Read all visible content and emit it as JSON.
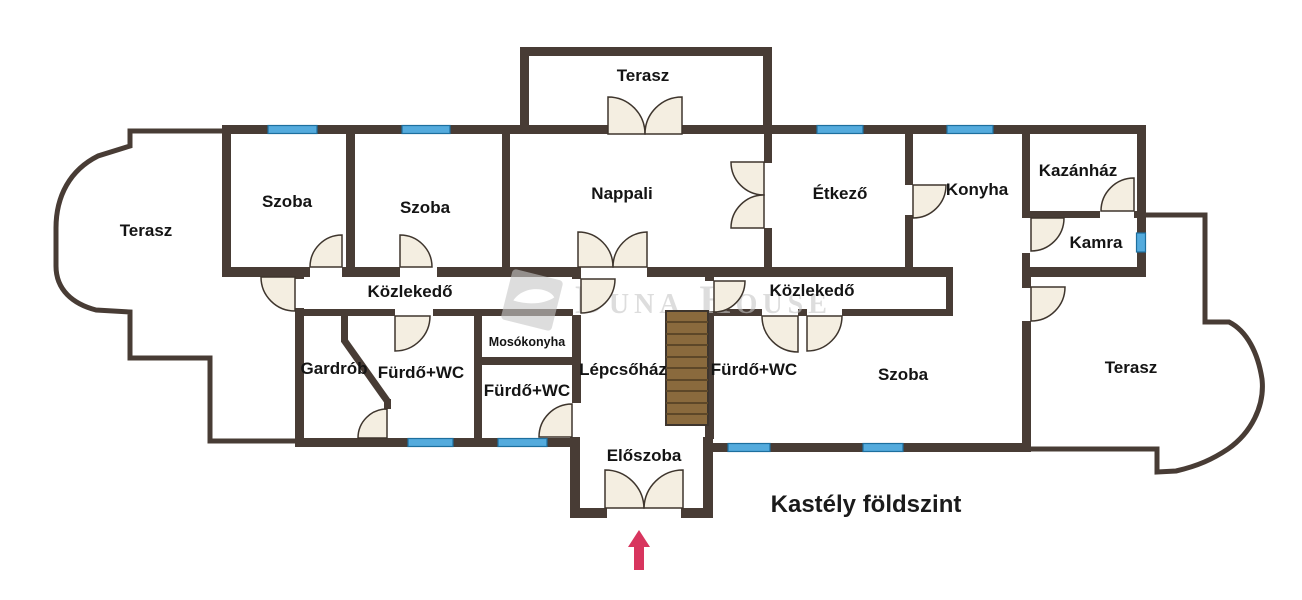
{
  "title": "Kastély földszint",
  "watermark": {
    "brand": "Duna House"
  },
  "rooms": {
    "terasz_top": "Terasz",
    "szoba_1": "Szoba",
    "szoba_2": "Szoba",
    "nappali": "Nappali",
    "etkezo": "Étkező",
    "konyha": "Konyha",
    "kazanhaz": "Kazánház",
    "kamra": "Kamra",
    "terasz_left": "Terasz",
    "kozlekedo_left": "Közlekedő",
    "gardrob": "Gardrób",
    "furdo_wc_1": "Fürdő+WC",
    "mosokonyha": "Mosókonyha",
    "furdo_wc_2": "Fürdő+WC",
    "lepcsohaz": "Lépcsőház",
    "furdo_wc_3": "Fürdő+WC",
    "kozlekedo_right": "Közlekedő",
    "szoba_3": "Szoba",
    "terasz_right": "Terasz",
    "eloszoba": "Előszoba"
  },
  "colors": {
    "wall": "#483c35",
    "window": "#54abdd",
    "door_leaf": "#f4eee1",
    "stairs": "#8a6a3d",
    "entrance_arrow": "#d8355e",
    "watermark": "#c7c7c7",
    "label_text": "#141414"
  }
}
